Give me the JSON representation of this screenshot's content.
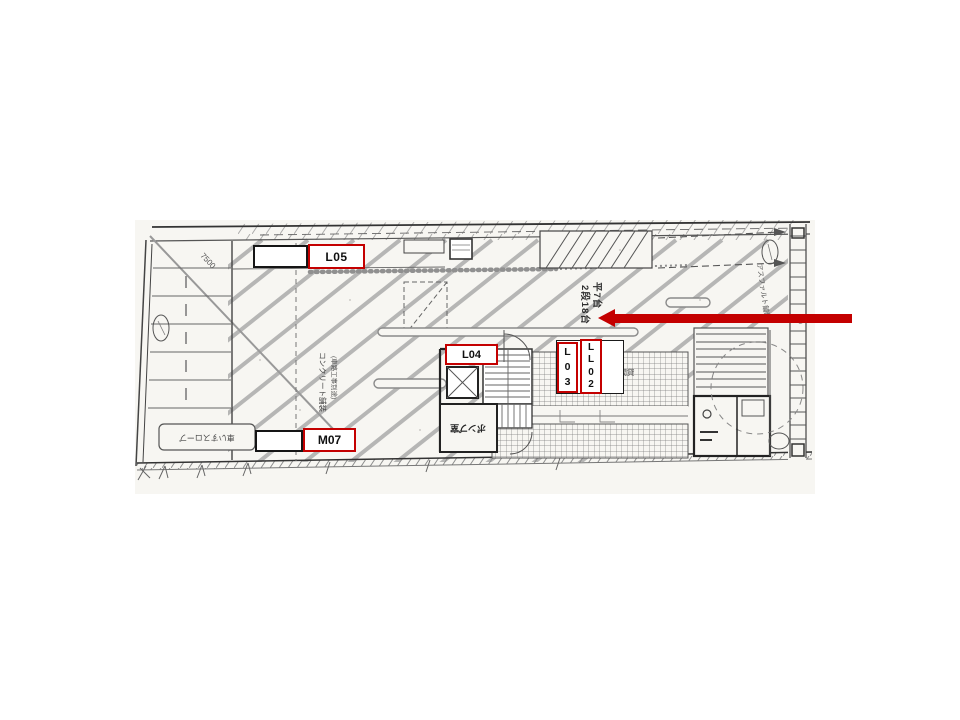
{
  "slide": {
    "background": "#ffffff"
  },
  "plan": {
    "paper_color": "#f7f6f2",
    "ink_color": "#3a3a3a",
    "annotations": {
      "capacity_col_right": "平7台",
      "capacity_col_left": "2段18台",
      "asphalt": "アスファルト舗装",
      "concrete": "コンクリート舗装",
      "concrete_note": "(車路工事別途)",
      "hourly_parking": "時間貸",
      "pump_room": "ポンプ室",
      "wheelchair_slope": "車いすスロープ",
      "dimension": "7500",
      "level_mark": "±0"
    }
  },
  "overlays": {
    "accent_color": "#c40000",
    "labels": {
      "l05": "L05",
      "l04": "L04",
      "l03": "L\n0\n3",
      "l02": "L\nL\n0\n2",
      "m07": "M07"
    },
    "arrow_direction": "left"
  }
}
